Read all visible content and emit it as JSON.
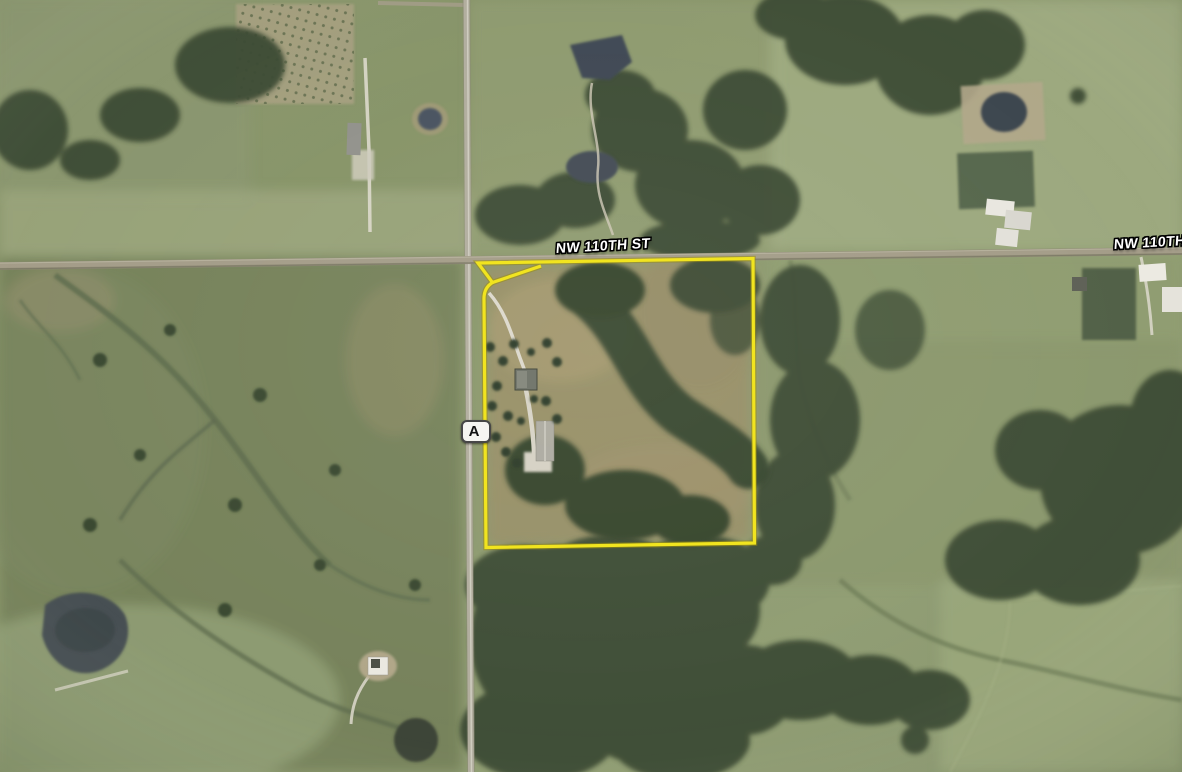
{
  "road_labels": {
    "center": "NW 110TH ST",
    "right_edge": "NW 110TH ST"
  },
  "highway_shield": {
    "label": "A"
  },
  "colors": {
    "parcel_outline": "#f1e41f",
    "parcel_outline_edge": "#9a8e10",
    "label_text": "#ffffff",
    "shield_text": "#121212",
    "shield_fill": "#f6f5f1",
    "road_surface": "#a49d89",
    "pond_water": "#414b55",
    "tree_canopy": "#3c4b34"
  }
}
